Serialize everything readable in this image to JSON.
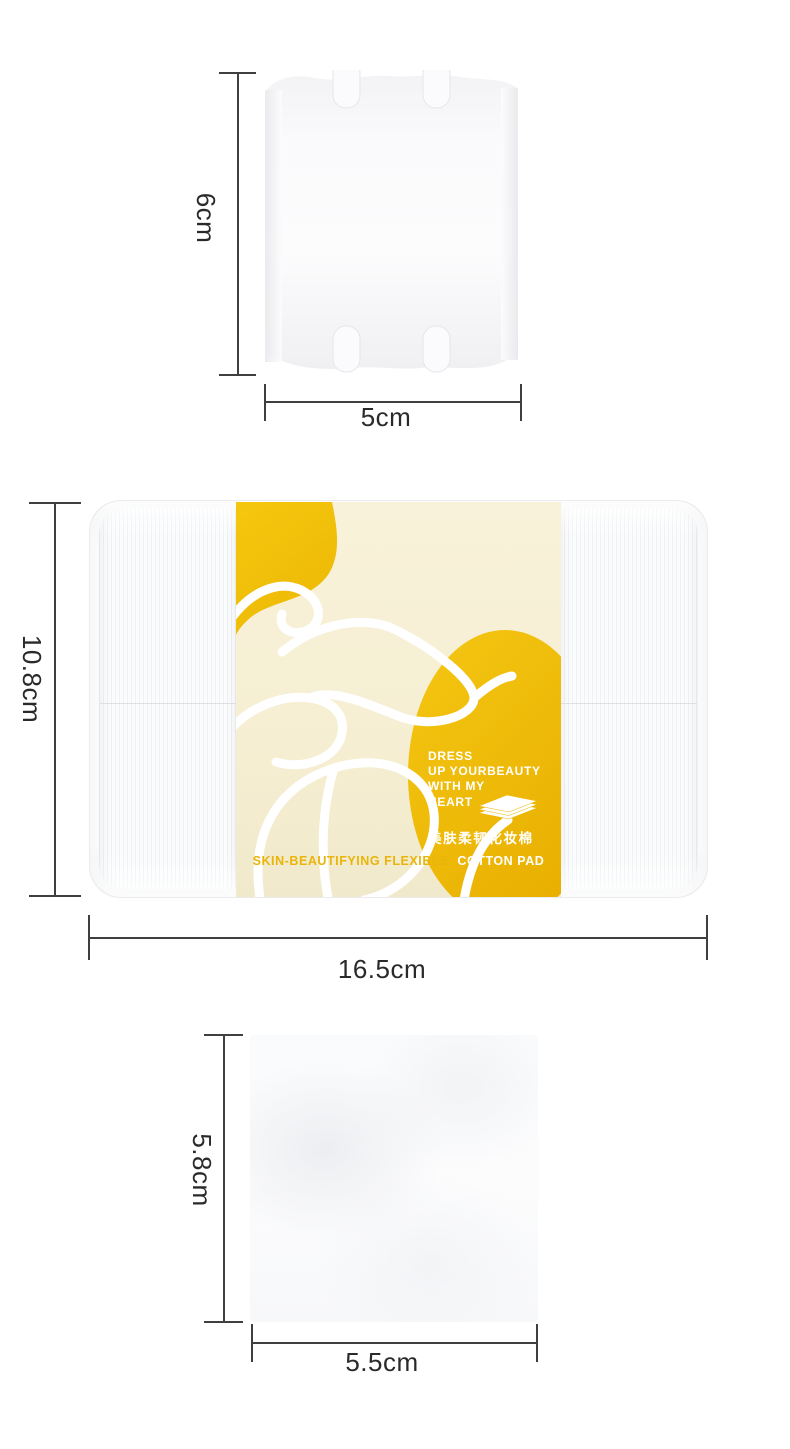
{
  "page": {
    "type": "product-size-diagram",
    "background": "#ffffff"
  },
  "colors": {
    "accent_yellow": "#F2C00F",
    "accent_yellow_deep": "#EAB303",
    "label_cream": "#F6EFD3",
    "dimension_line": "#3F3F3F",
    "dimension_text": "#2A2A2A",
    "gold_text": "#E9B50B",
    "white": "#FFFFFF"
  },
  "icons": {
    "pad_stack": "cotton-pad-stack-icon",
    "flower": "flower-line-art",
    "blob": "yellow-blob-shape",
    "oval": "yellow-oval-shape"
  },
  "sections": {
    "top_pad": {
      "height_label": "6cm",
      "width_label": "5cm"
    },
    "package": {
      "height_label": "10.8cm",
      "width_label": "16.5cm",
      "label": {
        "slogan_lines": [
          "DRESS",
          "UP YOURBEAUTY",
          "WITH MY",
          "HEART"
        ],
        "chinese_name": "美肤柔韧化妆棉",
        "english_name_left": "SKIN-BEAUTIFYING FLEXIBLE",
        "english_name_right": "COTTON PAD"
      }
    },
    "bottom_pad": {
      "height_label": "5.8cm",
      "width_label": "5.5cm"
    }
  }
}
